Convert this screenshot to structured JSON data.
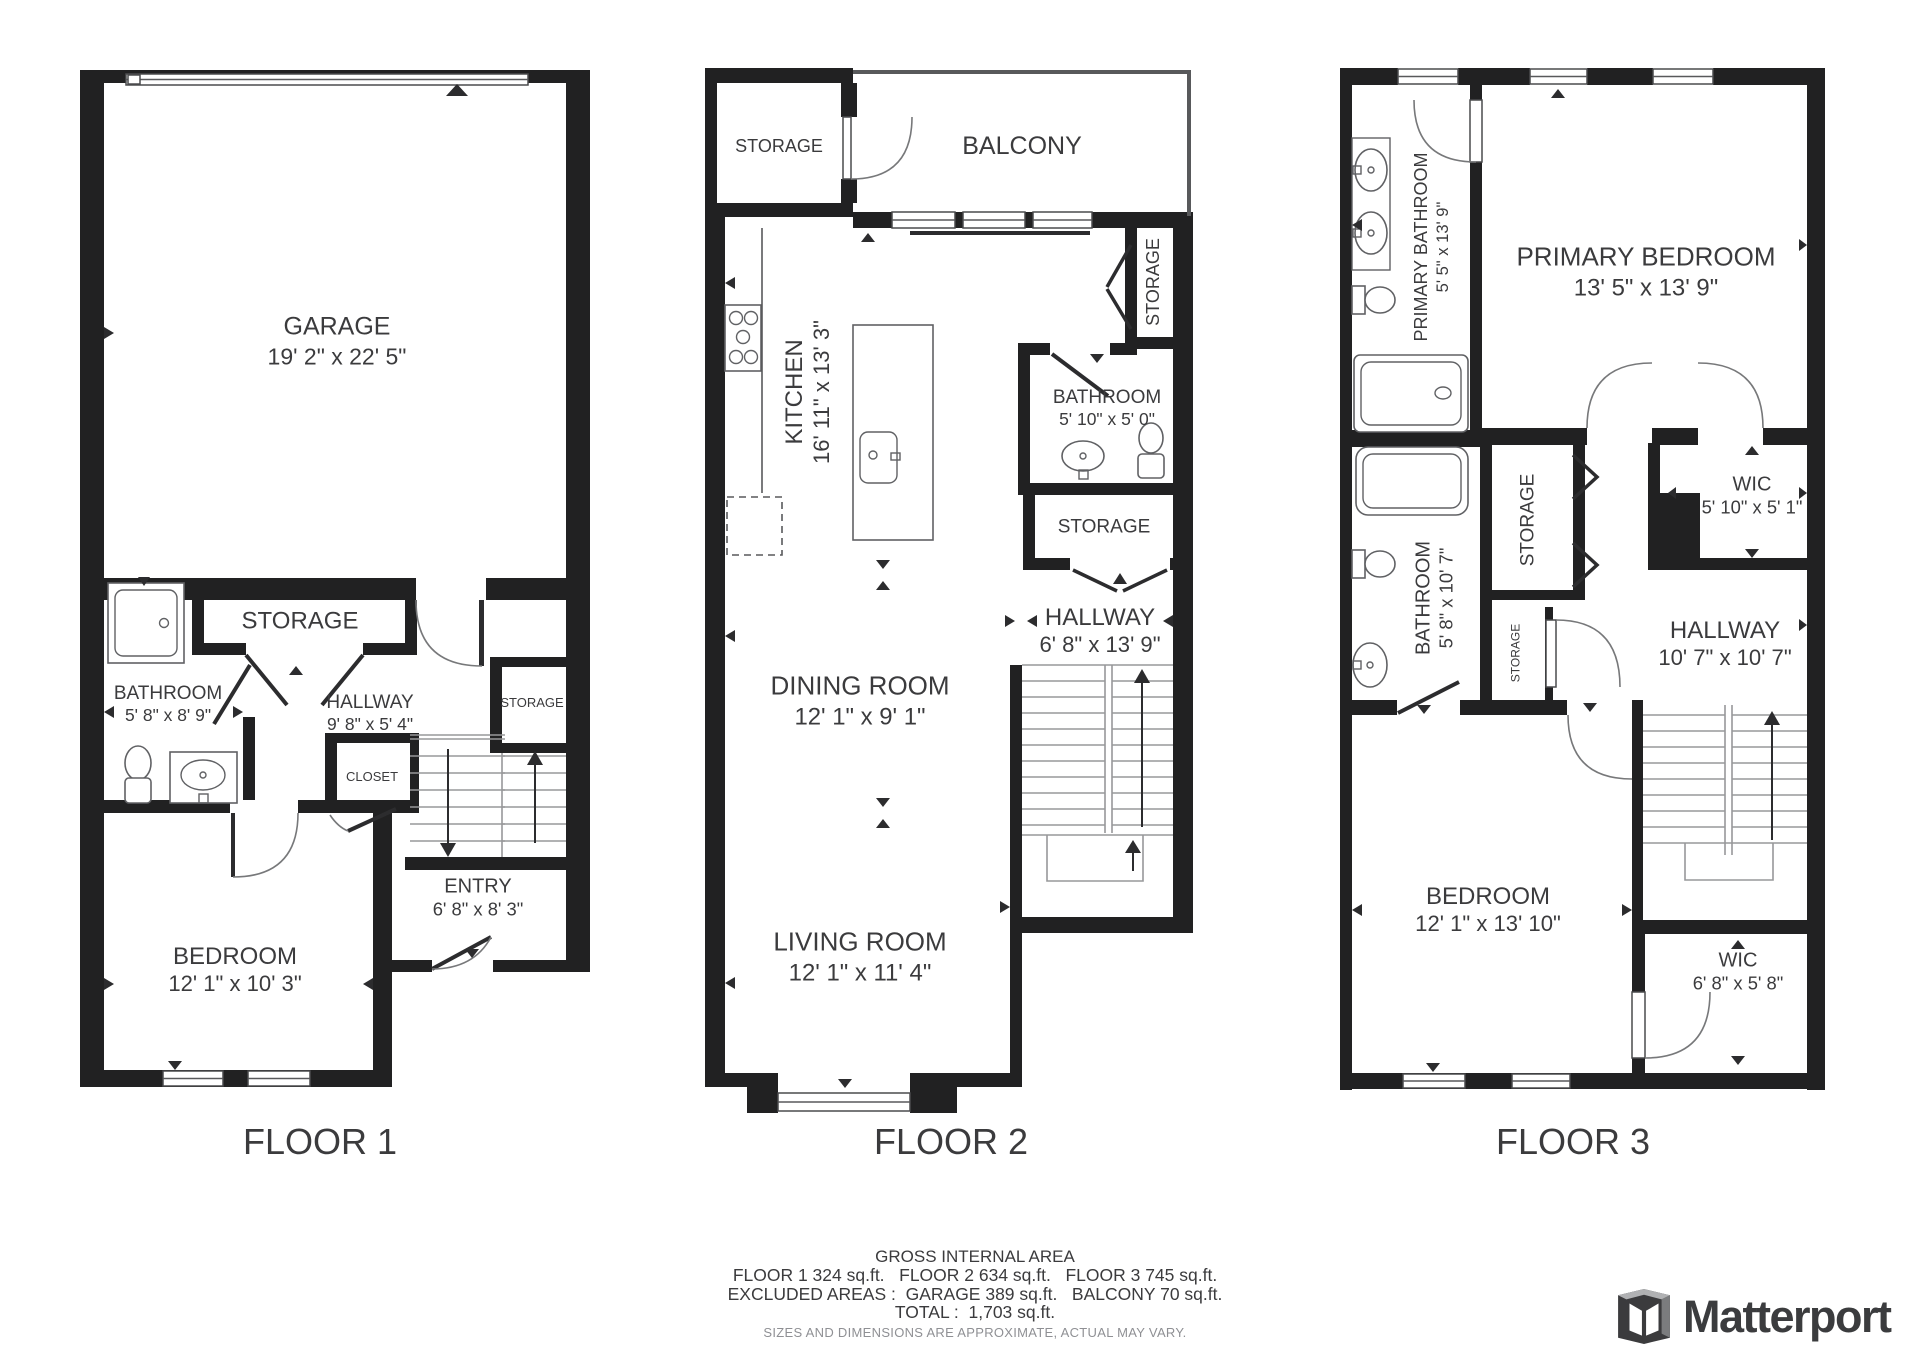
{
  "f1": {
    "label": "FLOOR 1",
    "garage": {
      "name": "GARAGE",
      "dims": "19' 2\" x 22' 5\""
    },
    "storage": {
      "name": "STORAGE"
    },
    "bathroom": {
      "name": "BATHROOM",
      "dims": "5' 8\" x 8' 9\""
    },
    "hallway": {
      "name": "HALLWAY",
      "dims": "9' 8\" x 5' 4\""
    },
    "closet": {
      "name": "CLOSET"
    },
    "storage2": {
      "name": "STORAGE"
    },
    "entry": {
      "name": "ENTRY",
      "dims": "6' 8\" x 8' 3\""
    },
    "bedroom": {
      "name": "BEDROOM",
      "dims": "12' 1\" x 10' 3\""
    }
  },
  "f2": {
    "label": "FLOOR 2",
    "storage_top": {
      "name": "STORAGE"
    },
    "balcony": {
      "name": "BALCONY"
    },
    "kitchen": {
      "name": "KITCHEN",
      "dims": "16' 11\" x 13' 3\""
    },
    "storage_right": {
      "name": "STORAGE"
    },
    "bathroom": {
      "name": "BATHROOM",
      "dims": "5' 10\" x 5' 0\""
    },
    "storage_mid": {
      "name": "STORAGE"
    },
    "hallway": {
      "name": "HALLWAY",
      "dims": "6' 8\" x 13' 9\""
    },
    "dining": {
      "name": "DINING ROOM",
      "dims": "12' 1\" x 9' 1\""
    },
    "living": {
      "name": "LIVING ROOM",
      "dims": "12' 1\" x 11' 4\""
    }
  },
  "f3": {
    "label": "FLOOR 3",
    "primary_bathroom": {
      "name": "PRIMARY BATHROOM",
      "dims": "5' 5\" x 13' 9\""
    },
    "primary_bedroom": {
      "name": "PRIMARY BEDROOM",
      "dims": "13' 5\" x 13' 9\""
    },
    "storage_big": {
      "name": "STORAGE"
    },
    "wic_top": {
      "name": "WIC",
      "dims": "5' 10\" x 5' 1\""
    },
    "bathroom": {
      "name": "BATHROOM",
      "dims": "5' 8\" x 10' 7\""
    },
    "storage_small": {
      "name": "STORAGE"
    },
    "hallway": {
      "name": "HALLWAY",
      "dims": "10' 7\" x 10' 7\""
    },
    "bedroom": {
      "name": "BEDROOM",
      "dims": "12' 1\" x 13' 10\""
    },
    "wic_bottom": {
      "name": "WIC",
      "dims": "6' 8\" x 5' 8\""
    }
  },
  "footer": {
    "title": "GROSS INTERNAL AREA",
    "line1": "FLOOR 1 324 sq.ft.   FLOOR 2 634 sq.ft.   FLOOR 3 745 sq.ft.",
    "line2": "EXCLUDED AREAS :  GARAGE 389 sq.ft.   BALCONY 70 sq.ft.",
    "total": "TOTAL :  1,703 sq.ft.",
    "disclaimer": "SIZES AND DIMENSIONS ARE APPROXIMATE, ACTUAL MAY VARY."
  },
  "brand": {
    "name": "Matterport"
  },
  "colors": {
    "wall": "#212122",
    "text": "#3b3b3d",
    "muted": "#8f9094",
    "stair_line": "#97989a",
    "brand_text": "#3b3c3e"
  }
}
